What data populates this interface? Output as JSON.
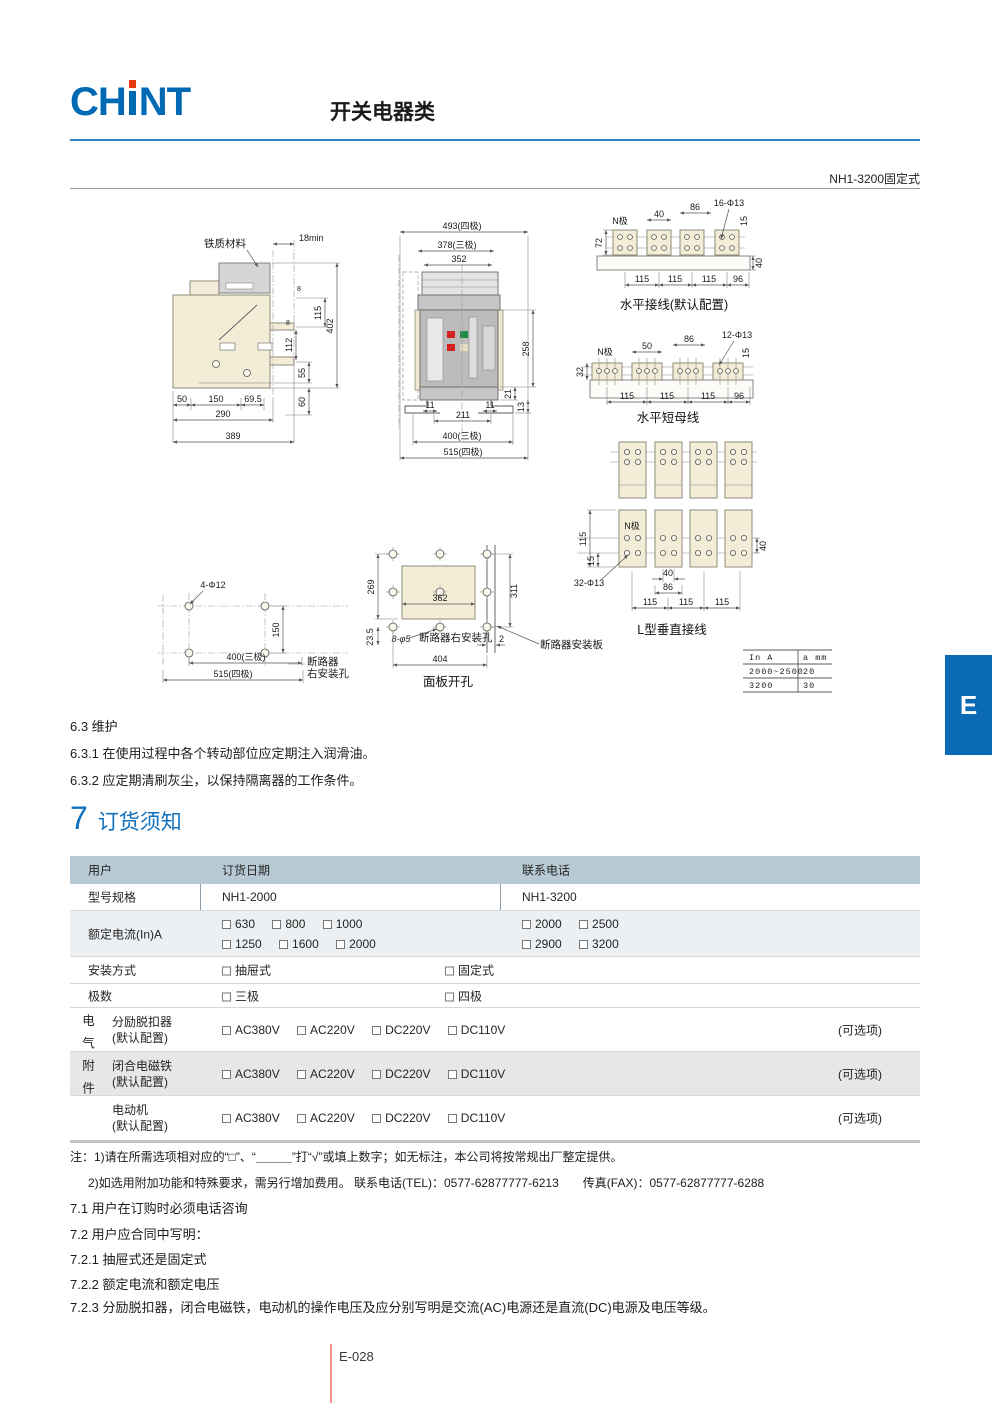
{
  "header": {
    "logo_ch": "CH",
    "logo_nt": "NT",
    "category_title": "开关电器类",
    "product_label": "NH1-3200固定式"
  },
  "drawings": {
    "side_view": {
      "material": "铁质材料",
      "d18": "18min",
      "d115": "115",
      "d402": "402",
      "d8": "8",
      "d112": "112",
      "d55": "55",
      "d60": "60",
      "d50": "50",
      "d150": "150",
      "d69_5": "69.5",
      "d290": "290",
      "d389": "389"
    },
    "front_view": {
      "d493": "493(四极)",
      "d378": "378(三极)",
      "d352": "352",
      "d258": "258",
      "d21": "21",
      "d11": "11",
      "d211": "211",
      "d13": "13",
      "d400": "400(三极)",
      "d515": "515(四极)"
    },
    "horizontal_wiring": {
      "title": "水平接线(默认配置)",
      "n_pole": "N极",
      "d40": "40",
      "d86": "86",
      "holes": "16-Φ13",
      "d15": "15",
      "d72": "72",
      "d115": "115",
      "d96": "96"
    },
    "horizontal_busbar": {
      "title": "水平短母线",
      "n_pole": "N极",
      "d50": "50",
      "d86": "86",
      "holes": "12-Φ13",
      "d15": "15",
      "d32": "32",
      "d115": "115",
      "d96": "96"
    },
    "l_vertical": {
      "title": "L型垂直接线",
      "n_pole": "N极",
      "d115": "115",
      "d15": "15",
      "holes": "32-Φ13",
      "d40": "40",
      "d86": "86"
    },
    "mounting_holes": {
      "holes": "4-Φ12",
      "d150": "150",
      "d400": "400(三极)",
      "d515": "515(四极)",
      "label1": "断路器",
      "label2": "右安装孔"
    },
    "panel_cutout": {
      "title": "面板开孔",
      "d269": "269",
      "d362": "362",
      "d311": "311",
      "d23_5": "23.5",
      "holes": "8-φ5",
      "right_hole": "断路器右安装孔",
      "d2": "2",
      "plate": "断路器安装板",
      "d404": "404"
    },
    "spec_table": {
      "h1": "In A",
      "h2": "a mm",
      "r1c1": "2000~2500",
      "r1c2": "20",
      "r2c1": "3200",
      "r2c2": "30"
    }
  },
  "maintenance": {
    "s1": "6.3 维护",
    "s2": "6.3.1 在使用过程中各个转动部位应定期注入润滑油。",
    "s3": "6.3.2 应定期清刷灰尘，以保持隔离器的工作条件。"
  },
  "ordering": {
    "number": "7",
    "title": "订货须知",
    "table": {
      "user": "用户",
      "order_date": "订货日期",
      "contact": "联系电话",
      "model_label": "型号规格",
      "model_left": "NH1-2000",
      "model_right": "NH1-3200",
      "current_label": "额定电流(In)A",
      "left1": [
        "630",
        "800",
        "1000"
      ],
      "left2": [
        "1250",
        "1600",
        "2000"
      ],
      "right1": [
        "2000",
        "2500"
      ],
      "right2": [
        "2900",
        "3200"
      ],
      "mount_label": "安装方式",
      "mount_opt1": "抽屉式",
      "mount_opt2": "固定式",
      "poles_label": "极数",
      "poles_opt1": "三极",
      "poles_opt2": "四极",
      "accessories_label": "电气附件",
      "acc": [
        {
          "name": "分励脱扣器",
          "sub": "(默认配置)",
          "opts": [
            "AC380V",
            "AC220V",
            "DC220V",
            "DC110V"
          ],
          "note": "(可选项)"
        },
        {
          "name": "闭合电磁铁",
          "sub": "(默认配置)",
          "opts": [
            "AC380V",
            "AC220V",
            "DC220V",
            "DC110V"
          ],
          "note": "(可选项)"
        },
        {
          "name": "电动机",
          "sub": "(默认配置)",
          "opts": [
            "AC380V",
            "AC220V",
            "DC220V",
            "DC110V"
          ],
          "note": "(可选项)"
        }
      ]
    },
    "notes": [
      "注：1)请在所需选项相对应的“□”、“＿＿＿”打“√”或填上数字；如无标注，本公司将按常规出厂整定提供。",
      "2)如选用附加功能和特殊要求，需另行增加费用。 联系电话(TEL)：0577-62877777-6213　　传真(FAX)：0577-62877777-6288"
    ],
    "items": [
      "7.1 用户在订购时必须电话咨询",
      "7.2 用户应合同中写明：",
      "7.2.1 抽屉式还是固定式",
      "7.2.2 额定电流和额定电压",
      "7.2.3 分励脱扣器，闭合电磁铁，电动机的操作电压及应分别写明是交流(AC)电源还是直流(DC)电源及电压等级。"
    ]
  },
  "footer": {
    "page_number": "E-028",
    "side_tab": "E"
  }
}
